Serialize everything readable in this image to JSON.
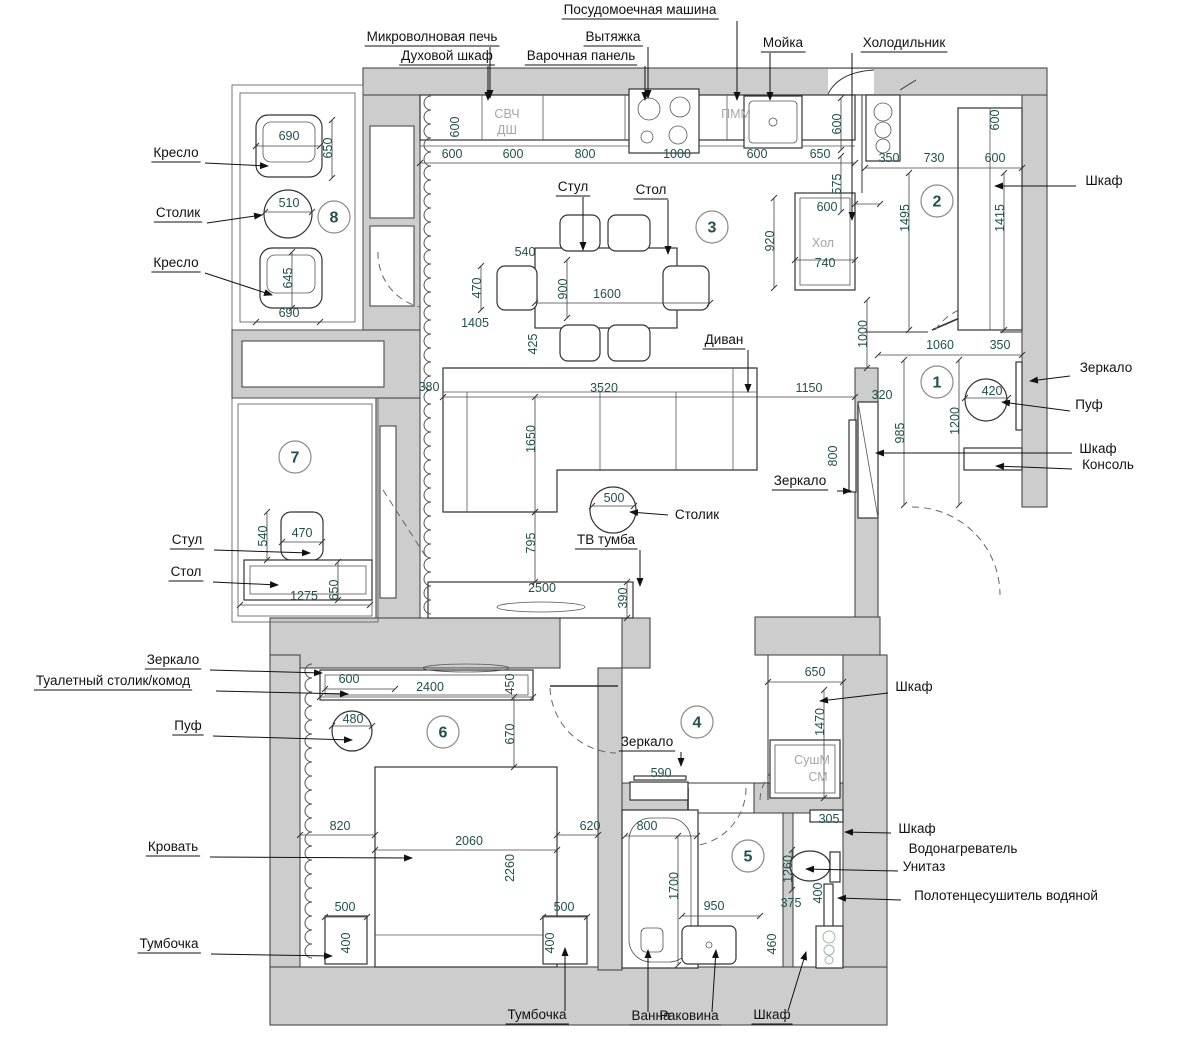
{
  "colors": {
    "wall": "#cdcdcd",
    "line": "#333333",
    "dim_text": "#1f514d",
    "label_text": "#111111",
    "muted_text": "#a6a6a6",
    "room_circle": "#8a8a8a"
  },
  "rooms": [
    {
      "n": "1",
      "x": 937,
      "y": 382
    },
    {
      "n": "2",
      "x": 937,
      "y": 201
    },
    {
      "n": "3",
      "x": 712,
      "y": 227
    },
    {
      "n": "4",
      "x": 697,
      "y": 722
    },
    {
      "n": "5",
      "x": 748,
      "y": 856
    },
    {
      "n": "6",
      "x": 443,
      "y": 732
    },
    {
      "n": "7",
      "x": 295,
      "y": 457
    },
    {
      "n": "8",
      "x": 334,
      "y": 217
    }
  ],
  "appliances": [
    {
      "t": "СВЧ",
      "x": 507,
      "y": 118
    },
    {
      "t": "ДШ",
      "x": 507,
      "y": 134
    },
    {
      "t": "ПММ",
      "x": 736,
      "y": 118
    },
    {
      "t": "Хол",
      "x": 823,
      "y": 247
    },
    {
      "t": "СушМ",
      "x": 812,
      "y": 764
    },
    {
      "t": "СМ",
      "x": 818,
      "y": 781
    }
  ],
  "dims": [
    {
      "t": "600",
      "x": 452,
      "y": 158
    },
    {
      "t": "600",
      "x": 513,
      "y": 158
    },
    {
      "t": "800",
      "x": 585,
      "y": 158
    },
    {
      "t": "1000",
      "x": 677,
      "y": 158
    },
    {
      "t": "600",
      "x": 757,
      "y": 158
    },
    {
      "t": "650",
      "x": 820,
      "y": 158
    },
    {
      "t": "600",
      "x": 459,
      "y": 127,
      "r": 1
    },
    {
      "t": "600",
      "x": 841,
      "y": 124,
      "r": 1
    },
    {
      "t": "575",
      "x": 841,
      "y": 184,
      "r": 1
    },
    {
      "t": "600",
      "x": 827,
      "y": 211
    },
    {
      "t": "740",
      "x": 825,
      "y": 267
    },
    {
      "t": "920",
      "x": 774,
      "y": 241,
      "r": 1
    },
    {
      "t": "350",
      "x": 889,
      "y": 162
    },
    {
      "t": "730",
      "x": 934,
      "y": 162
    },
    {
      "t": "600",
      "x": 995,
      "y": 162
    },
    {
      "t": "600",
      "x": 999,
      "y": 120,
      "r": 1
    },
    {
      "t": "1495",
      "x": 909,
      "y": 218,
      "r": 1
    },
    {
      "t": "1415",
      "x": 1004,
      "y": 218,
      "r": 1
    },
    {
      "t": "690",
      "x": 289,
      "y": 140
    },
    {
      "t": "650",
      "x": 332,
      "y": 148,
      "r": 1
    },
    {
      "t": "510",
      "x": 289,
      "y": 207
    },
    {
      "t": "645",
      "x": 292,
      "y": 278,
      "r": 1
    },
    {
      "t": "690",
      "x": 289,
      "y": 317
    },
    {
      "t": "540",
      "x": 267,
      "y": 536,
      "r": 1
    },
    {
      "t": "470",
      "x": 302,
      "y": 537
    },
    {
      "t": "1275",
      "x": 304,
      "y": 600
    },
    {
      "t": "650",
      "x": 338,
      "y": 590,
      "r": 1
    },
    {
      "t": "540",
      "x": 525,
      "y": 256
    },
    {
      "t": "470",
      "x": 481,
      "y": 288,
      "r": 1
    },
    {
      "t": "900",
      "x": 567,
      "y": 289,
      "r": 1
    },
    {
      "t": "1600",
      "x": 607,
      "y": 298
    },
    {
      "t": "1405",
      "x": 475,
      "y": 327
    },
    {
      "t": "425",
      "x": 537,
      "y": 344,
      "r": 1
    },
    {
      "t": "380",
      "x": 429,
      "y": 391
    },
    {
      "t": "3520",
      "x": 604,
      "y": 392
    },
    {
      "t": "1150",
      "x": 809,
      "y": 392
    },
    {
      "t": "1650",
      "x": 535,
      "y": 439,
      "r": 1
    },
    {
      "t": "795",
      "x": 535,
      "y": 543,
      "r": 1
    },
    {
      "t": "500",
      "x": 614,
      "y": 502
    },
    {
      "t": "2500",
      "x": 542,
      "y": 592
    },
    {
      "t": "390",
      "x": 627,
      "y": 598,
      "r": 1
    },
    {
      "t": "800",
      "x": 837,
      "y": 456,
      "r": 1
    },
    {
      "t": "1000",
      "x": 867,
      "y": 334,
      "r": 1
    },
    {
      "t": "1060",
      "x": 940,
      "y": 349
    },
    {
      "t": "350",
      "x": 1000,
      "y": 349
    },
    {
      "t": "320",
      "x": 882,
      "y": 399
    },
    {
      "t": "985",
      "x": 904,
      "y": 433,
      "r": 1
    },
    {
      "t": "1200",
      "x": 959,
      "y": 421,
      "r": 1
    },
    {
      "t": "420",
      "x": 992,
      "y": 395
    },
    {
      "t": "600",
      "x": 349,
      "y": 683
    },
    {
      "t": "2400",
      "x": 430,
      "y": 691
    },
    {
      "t": "450",
      "x": 514,
      "y": 684,
      "r": 1
    },
    {
      "t": "480",
      "x": 353,
      "y": 723
    },
    {
      "t": "670",
      "x": 514,
      "y": 734,
      "r": 1
    },
    {
      "t": "820",
      "x": 340,
      "y": 830
    },
    {
      "t": "2060",
      "x": 469,
      "y": 845
    },
    {
      "t": "620",
      "x": 590,
      "y": 830
    },
    {
      "t": "2260",
      "x": 514,
      "y": 868,
      "r": 1
    },
    {
      "t": "500",
      "x": 345,
      "y": 911
    },
    {
      "t": "400",
      "x": 350,
      "y": 943,
      "r": 1
    },
    {
      "t": "500",
      "x": 564,
      "y": 911
    },
    {
      "t": "400",
      "x": 554,
      "y": 943,
      "r": 1
    },
    {
      "t": "590",
      "x": 661,
      "y": 777
    },
    {
      "t": "650",
      "x": 815,
      "y": 676
    },
    {
      "t": "1470",
      "x": 824,
      "y": 722,
      "r": 1
    },
    {
      "t": "800",
      "x": 647,
      "y": 830
    },
    {
      "t": "1700",
      "x": 678,
      "y": 886,
      "r": 1
    },
    {
      "t": "950",
      "x": 714,
      "y": 910
    },
    {
      "t": "375",
      "x": 791,
      "y": 907
    },
    {
      "t": "460",
      "x": 776,
      "y": 944,
      "r": 1
    },
    {
      "t": "305",
      "x": 829,
      "y": 823
    },
    {
      "t": "1260",
      "x": 792,
      "y": 869,
      "r": 1
    },
    {
      "t": "400",
      "x": 822,
      "y": 893,
      "r": 1
    }
  ],
  "labels": [
    {
      "t": "Посудомоечная машина",
      "x": 640,
      "y": 14,
      "u": 1,
      "l": [
        [
          737,
          21
        ],
        [
          737,
          100
        ]
      ]
    },
    {
      "t": "Микроволновая печь",
      "x": 432,
      "y": 41,
      "u": 1,
      "l": [
        [
          490,
          47
        ],
        [
          490,
          98
        ]
      ]
    },
    {
      "t": "Духовой шкаф",
      "x": 447,
      "y": 60,
      "u": 1,
      "l": [
        [
          488,
          66
        ],
        [
          488,
          100
        ]
      ]
    },
    {
      "t": "Вытяжка",
      "x": 613,
      "y": 41,
      "u": 1,
      "l": [
        [
          648,
          47
        ],
        [
          648,
          98
        ]
      ]
    },
    {
      "t": "Варочная панель",
      "x": 581,
      "y": 60,
      "u": 1,
      "l": [
        [
          645,
          66
        ],
        [
          645,
          100
        ]
      ]
    },
    {
      "t": "Мойка",
      "x": 783,
      "y": 47,
      "u": 1,
      "l": [
        [
          770,
          53
        ],
        [
          770,
          100
        ]
      ]
    },
    {
      "t": "Холодильник",
      "x": 904,
      "y": 47,
      "u": 1,
      "l": [
        [
          852,
          53
        ],
        [
          852,
          220
        ]
      ]
    },
    {
      "t": "Кресло",
      "x": 176,
      "y": 157,
      "u": 1,
      "l": [
        [
          205,
          163
        ],
        [
          268,
          166
        ]
      ]
    },
    {
      "t": "Столик",
      "x": 178,
      "y": 217,
      "u": 1,
      "l": [
        [
          207,
          223
        ],
        [
          262,
          215
        ]
      ]
    },
    {
      "t": "Кресло",
      "x": 176,
      "y": 267,
      "u": 1,
      "l": [
        [
          205,
          273
        ],
        [
          272,
          295
        ]
      ]
    },
    {
      "t": "Шкаф",
      "x": 1104,
      "y": 185,
      "u": 0,
      "l": [
        [
          1076,
          186
        ],
        [
          995,
          186
        ]
      ]
    },
    {
      "t": "Зеркало",
      "x": 1106,
      "y": 372,
      "u": 0,
      "l": [
        [
          1070,
          376
        ],
        [
          1030,
          381
        ]
      ]
    },
    {
      "t": "Пуф",
      "x": 1089,
      "y": 409,
      "u": 0,
      "l": [
        [
          1070,
          411
        ],
        [
          1002,
          402
        ]
      ]
    },
    {
      "t": "Шкаф",
      "x": 1098,
      "y": 453,
      "u": 0,
      "l": [
        [
          1072,
          453
        ],
        [
          876,
          453
        ]
      ]
    },
    {
      "t": "Консоль",
      "x": 1108,
      "y": 469,
      "u": 0,
      "l": [
        [
          1072,
          469
        ],
        [
          996,
          466
        ]
      ]
    },
    {
      "t": "Диван",
      "x": 724,
      "y": 344,
      "u": 1,
      "l": [
        [
          748,
          350
        ],
        [
          748,
          392
        ]
      ]
    },
    {
      "t": "Стул",
      "x": 573,
      "y": 191,
      "u": 1,
      "l": [
        [
          583,
          197
        ],
        [
          583,
          250
        ]
      ]
    },
    {
      "t": "Стол",
      "x": 651,
      "y": 194,
      "u": 1,
      "l": [
        [
          668,
          200
        ],
        [
          668,
          254
        ]
      ]
    },
    {
      "t": "Зеркало",
      "x": 800,
      "y": 485,
      "u": 1,
      "l": [
        [
          837,
          491
        ],
        [
          851,
          491
        ]
      ]
    },
    {
      "t": "Столик",
      "x": 697,
      "y": 519,
      "u": 0,
      "l": [
        [
          668,
          515
        ],
        [
          630,
          512
        ]
      ]
    },
    {
      "t": "ТВ тумба",
      "x": 606,
      "y": 544,
      "u": 1,
      "l": [
        [
          640,
          550
        ],
        [
          640,
          586
        ]
      ]
    },
    {
      "t": "Стул",
      "x": 187,
      "y": 544,
      "u": 1,
      "l": [
        [
          214,
          550
        ],
        [
          310,
          553
        ]
      ]
    },
    {
      "t": "Стол",
      "x": 186,
      "y": 576,
      "u": 1,
      "l": [
        [
          213,
          582
        ],
        [
          278,
          585
        ]
      ]
    },
    {
      "t": "Зеркало",
      "x": 173,
      "y": 664,
      "u": 1,
      "l": [
        [
          210,
          670
        ],
        [
          322,
          673
        ]
      ]
    },
    {
      "t": "Туалетный столик/комод",
      "x": 113,
      "y": 685,
      "u": 1,
      "l": [
        [
          216,
          691
        ],
        [
          348,
          694
        ]
      ]
    },
    {
      "t": "Пуф",
      "x": 188,
      "y": 730,
      "u": 1,
      "l": [
        [
          213,
          736
        ],
        [
          352,
          740
        ]
      ]
    },
    {
      "t": "Кровать",
      "x": 173,
      "y": 851,
      "u": 1,
      "l": [
        [
          210,
          857
        ],
        [
          412,
          858
        ]
      ]
    },
    {
      "t": "Тумбочка",
      "x": 169,
      "y": 948,
      "u": 1,
      "l": [
        [
          211,
          954
        ],
        [
          332,
          956
        ]
      ]
    },
    {
      "t": "Зеркало",
      "x": 647,
      "y": 746,
      "u": 1,
      "l": [
        [
          681,
          752
        ],
        [
          681,
          766
        ]
      ]
    },
    {
      "t": "Шкаф",
      "x": 914,
      "y": 691,
      "u": 0,
      "l": [
        [
          888,
          693
        ],
        [
          820,
          701
        ]
      ]
    },
    {
      "t": "Шкаф",
      "x": 917,
      "y": 833,
      "u": 0,
      "l": [
        [
          891,
          833
        ],
        [
          845,
          832
        ]
      ]
    },
    {
      "t": "Водонагреватель",
      "x": 963,
      "y": 853,
      "u": 0
    },
    {
      "t": "Унитаз",
      "x": 924,
      "y": 871,
      "u": 0,
      "l": [
        [
          898,
          871
        ],
        [
          806,
          869
        ]
      ]
    },
    {
      "t": "Полотенцесушитель водяной",
      "x": 1006,
      "y": 900,
      "u": 0,
      "l": [
        [
          901,
          900
        ],
        [
          838,
          898
        ]
      ]
    },
    {
      "t": "Тумбочка",
      "x": 537,
      "y": 1019,
      "u": 1,
      "l": [
        [
          565,
          1011
        ],
        [
          565,
          948
        ]
      ]
    },
    {
      "t": "Ванна",
      "x": 651,
      "y": 1020,
      "u": 1,
      "l": [
        [
          648,
          1012
        ],
        [
          648,
          950
        ]
      ]
    },
    {
      "t": "Раковина",
      "x": 689,
      "y": 1020,
      "u": 1,
      "l": [
        [
          712,
          1012
        ],
        [
          716,
          950
        ]
      ]
    },
    {
      "t": "Шкаф",
      "x": 772,
      "y": 1019,
      "u": 1,
      "l": [
        [
          788,
          1011
        ],
        [
          806,
          952
        ]
      ]
    }
  ]
}
